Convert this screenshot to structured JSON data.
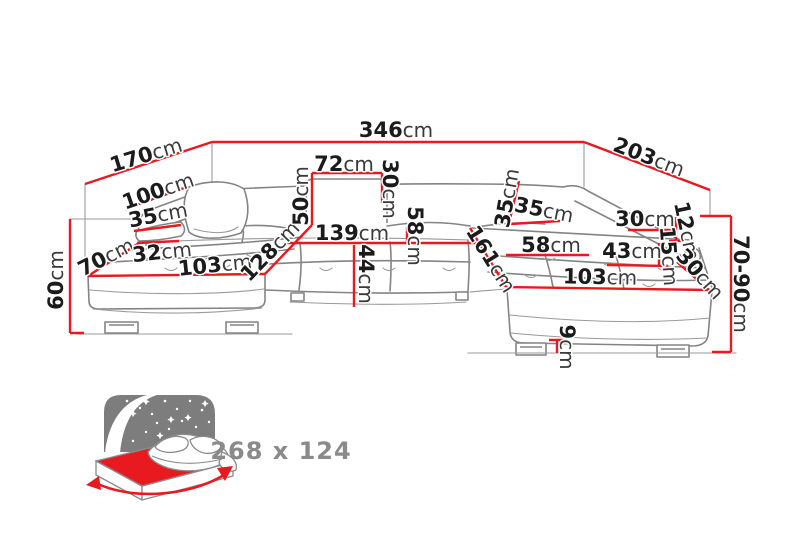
{
  "diagram": {
    "name": "corner-sofa-dimension-diagram",
    "unit_suffix": "cm",
    "dimensions": [
      {
        "id": "back-left-depth",
        "num": "170",
        "unit": "cm"
      },
      {
        "id": "total-width",
        "num": "346",
        "unit": "cm"
      },
      {
        "id": "back-right-depth",
        "num": "203",
        "unit": "cm"
      },
      {
        "id": "left-arm-length",
        "num": "100",
        "unit": "cm"
      },
      {
        "id": "left-arm-height",
        "num": "35",
        "unit": "cm"
      },
      {
        "id": "left-chaise-width",
        "num": "70",
        "unit": "cm"
      },
      {
        "id": "left-arm-width",
        "num": "32",
        "unit": "cm"
      },
      {
        "id": "left-chaise-length",
        "num": "103",
        "unit": "cm"
      },
      {
        "id": "left-inner-depth",
        "num": "128",
        "unit": "cm"
      },
      {
        "id": "headrest-height",
        "num": "50",
        "unit": "cm"
      },
      {
        "id": "headrest-width",
        "num": "72",
        "unit": "cm"
      },
      {
        "id": "headrest-depth",
        "num": "30",
        "unit": "cm"
      },
      {
        "id": "center-seat-width",
        "num": "139",
        "unit": "cm"
      },
      {
        "id": "center-back-depth",
        "num": "58",
        "unit": "cm"
      },
      {
        "id": "seat-depth",
        "num": "44",
        "unit": "cm"
      },
      {
        "id": "right-chaise-length",
        "num": "161",
        "unit": "cm"
      },
      {
        "id": "right-back-height",
        "num": "35",
        "unit": "cm"
      },
      {
        "id": "right-back-depth",
        "num": "35",
        "unit": "cm"
      },
      {
        "id": "right-seat-width",
        "num": "58",
        "unit": "cm"
      },
      {
        "id": "right-arm-top-width",
        "num": "30",
        "unit": "cm"
      },
      {
        "id": "right-arm-upper",
        "num": "12",
        "unit": "cm"
      },
      {
        "id": "right-arm-lower",
        "num": "15",
        "unit": "cm"
      },
      {
        "id": "right-seat-depth",
        "num": "43",
        "unit": "cm"
      },
      {
        "id": "right-corner-edge",
        "num": "30",
        "unit": "cm"
      },
      {
        "id": "right-chaise-front",
        "num": "103",
        "unit": "cm"
      },
      {
        "id": "total-height-range",
        "num": "70-90",
        "unit": "cm"
      },
      {
        "id": "leg-height",
        "num": "9",
        "unit": "cm"
      },
      {
        "id": "left-front-height",
        "num": "60",
        "unit": "cm"
      }
    ]
  },
  "sleeping_function": {
    "icon": "fold-out-bed-icon",
    "size_label": "268 x 124"
  },
  "colors": {
    "dimension_line": "#e8191f",
    "sofa_outline": "#848484",
    "label_text": "#1b1b1b",
    "unit_text": "#3a3a3a",
    "muted_label": "#8a8a8a",
    "bed_headboard": "#7d7d7d"
  }
}
